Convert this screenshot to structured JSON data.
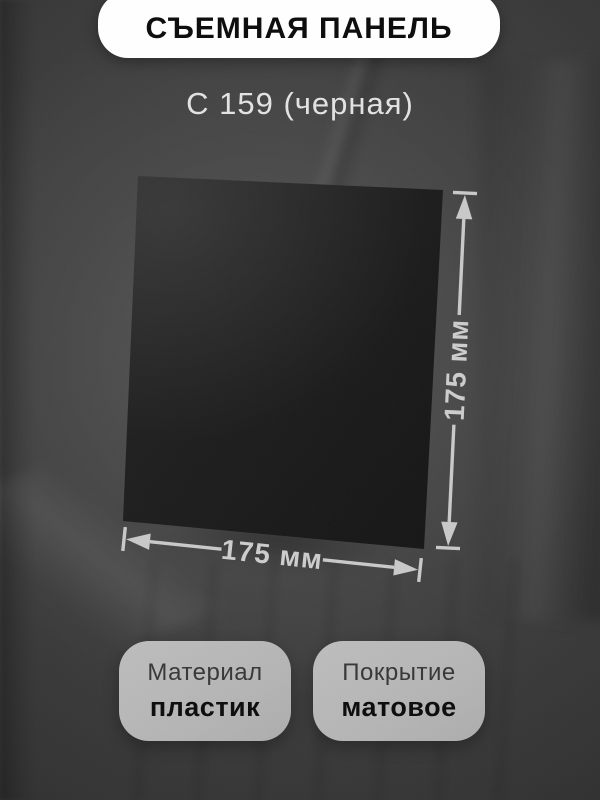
{
  "header": {
    "title": "СЪЕМНАЯ ПАНЕЛЬ"
  },
  "subtitle": {
    "text": "С 159 (черная)"
  },
  "product": {
    "name": "съемная панель С 159",
    "panel_color_name": "черная"
  },
  "dimensions": {
    "height_label": "175 мм",
    "width_label": "175 мм",
    "line_color": "#c9c9c9"
  },
  "specs": [
    {
      "label": "Материал",
      "value": "пластик"
    },
    {
      "label": "Покрытие",
      "value": "матовое"
    }
  ],
  "colors": {
    "background": "#3e3e3e",
    "pill": "#ffffff",
    "panel": "#1a1a1a",
    "spec_card": "#b7b7b7",
    "title_text": "#0b0b0b",
    "subtitle_text": "#e3e3e3"
  }
}
